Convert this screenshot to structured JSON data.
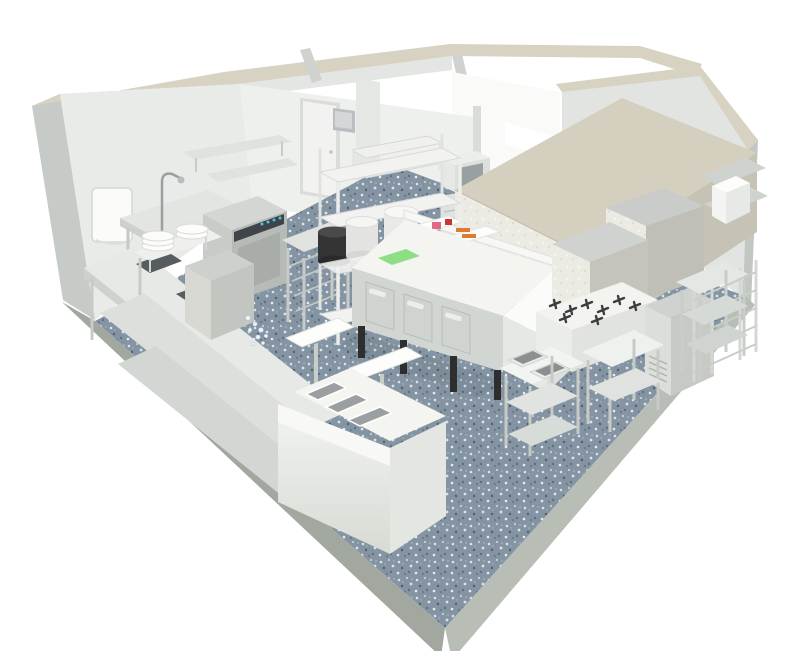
{
  "image": {
    "kind": "3d-render",
    "subject": "commercial kitchen floor plan",
    "view": "isometric cutaway from above",
    "width": 800,
    "height": 651
  },
  "colors": {
    "background": "#ffffff",
    "wall_top": "#d8d2c2",
    "wall_outer": "#c6cbc7",
    "wall_inner": "#e9ebe8",
    "back_wall": "#eef0ee",
    "right_wall": "#e1e4e1",
    "bright_room": "#fafaf8",
    "window_white": "#ffffff",
    "door": "#f2f3f1",
    "floor_base": "#8494a2",
    "floor_fleck_light": "#d9e3e9",
    "floor_fleck_dark": "#4f6170",
    "plinth_front": "#a2a79f",
    "plinth_side": "#b8bdb5",
    "hood_top": "#d5cfbf",
    "hood_front": "#ebeae3",
    "hood_side": "#c6c3b6",
    "steel_top": "#e6e9e5",
    "steel_front": "#d2d6d2",
    "steel_side": "#c0c4c0",
    "worktop_white": "#f4f5f1",
    "sink_well": "#575d5f",
    "cutting_board_green": "#8ede84",
    "food_orange": "#e07a2e",
    "food_pink": "#e06a86",
    "food_red": "#c93434",
    "food_yellow": "#ecd24c",
    "display_panel": "#3f4448",
    "display_light": "#49c3e8",
    "leg_black": "#2e2e2e",
    "ice_sparkle": "#eef4f8",
    "pot_black": "#343434"
  },
  "scene": {
    "rooms": [
      "main kitchen",
      "back storage rooms",
      "bright walk-in / servery room"
    ],
    "floor": "blue-grey speckled terrazzo on concrete plinth base",
    "equipment": [
      "paper towel dispenser",
      "pre-rinse spray faucet",
      "plate stacks on raised shelf",
      "double-bowl wash-up sink counter",
      "hood dishwasher with indicator lights",
      "tray slide table",
      "ice machine",
      "long work counter with undershelf",
      "wall shelves",
      "white wire shelving with stock pots",
      "black stock pot",
      "back room door",
      "wall-mounted control box",
      "microwave on base cabinet",
      "refrigerated prep counter with three doors",
      "green cutting board",
      "ingredient rail with vegetables",
      "neutral counter extension",
      "extraction hood canopy",
      "combi ovens",
      "gas range with cast-iron grates",
      "pass-through dishwasher",
      "tray rack",
      "right wall shelves with appliance",
      "tall shelf rack",
      "double-bowl sink table",
      "work tables with undershelves",
      "serving counter with bain-marie wells",
      "gantry shelves on posts"
    ]
  }
}
